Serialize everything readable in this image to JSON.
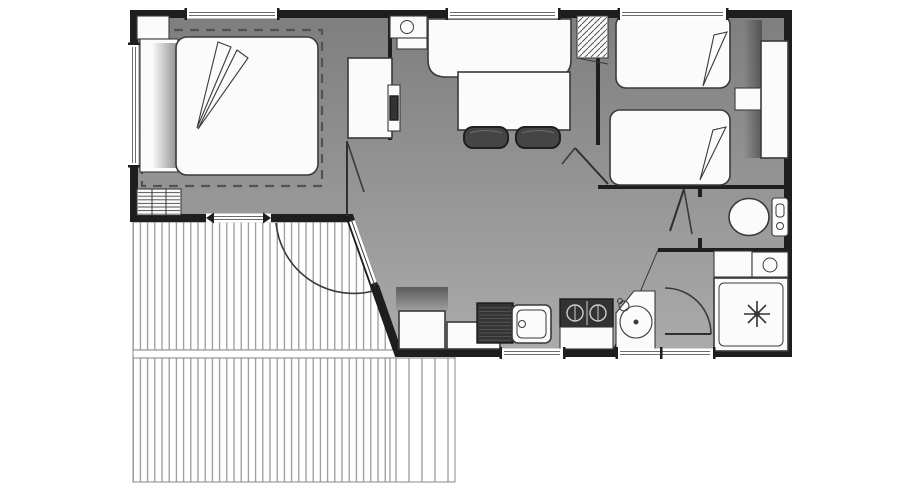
{
  "meta": {
    "type": "floor-plan",
    "description": "Black and white architectural floor plan of a two-bedroom mobile home with a slatted timber deck terrace at the front left",
    "canvas_width": 900,
    "canvas_height": 500
  },
  "colors": {
    "background": "#ffffff",
    "wall": "#1e1e1e",
    "floor_top": "#7e7e7e",
    "floor_bottom": "#ababab",
    "furniture_fill": "#fbfbfb",
    "furniture_stroke": "#3a3a3a",
    "appliance_dark": "#333333",
    "chair_fill": "#454545",
    "deck_line": "#898989",
    "deck_outline": "#9c9c9c",
    "window_fill": "#ffffff",
    "window_line": "#6b6b6b",
    "dashed_line": "#525252",
    "door_line": "#2f2f2f",
    "hatch_line": "#555555",
    "shadow": "#2e2e2e"
  },
  "rooms": {
    "master_bedroom": {
      "name": "master-bedroom",
      "items": [
        "double-bed",
        "headboard",
        "duvet-folds",
        "corner-cabinet",
        "drawers-unit",
        "bed-zone-dashed-outline",
        "interior-door"
      ]
    },
    "living_dining": {
      "name": "living-dining",
      "items": [
        "bench-sofa",
        "dining-table",
        "chair",
        "chair",
        "tv-cabinet",
        "wall-tv",
        "water-heater",
        "storage-shelves"
      ]
    },
    "kitchen": {
      "name": "kitchen",
      "items": [
        "sink",
        "draining-board",
        "hob",
        "base-unit",
        "base-unit"
      ]
    },
    "twin_bedroom": {
      "name": "twin-bedroom",
      "items": [
        "single-bed",
        "single-bed",
        "bedside-shelf",
        "wardrobe",
        "interior-door"
      ]
    },
    "wc": {
      "name": "wc",
      "items": [
        "toilet",
        "cistern",
        "interior-door"
      ]
    },
    "bathroom": {
      "name": "bathroom",
      "items": [
        "shower-tray",
        "shower-head-symbol",
        "round-washbasin",
        "vanity-unit",
        "washbasin-cabinet",
        "storage-cabinet",
        "interior-door"
      ]
    },
    "terrace": {
      "name": "terrace-deck",
      "items": [
        "upper-deck",
        "lower-deck",
        "deck-step-band",
        "entrance-door-swing"
      ]
    }
  },
  "openings": {
    "windows": 7,
    "exterior_doors": 1,
    "interior_doors": 4
  }
}
